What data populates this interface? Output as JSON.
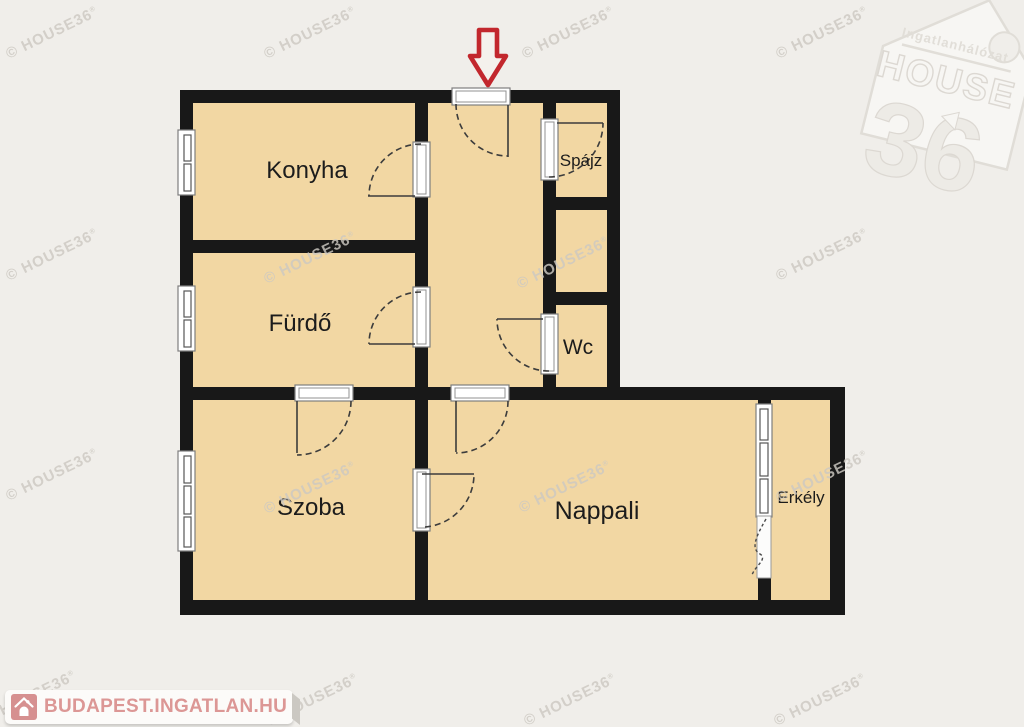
{
  "branding": {
    "watermark_text": "© HOUSE36",
    "watermark_mark": "®",
    "logo": {
      "tagline": "Ingatlanhálózat",
      "name": "HOUSE",
      "number": "36"
    },
    "footer_site": "BUDAPEST.INGATLAN.HU"
  },
  "floorplan": {
    "rooms": [
      {
        "id": "konyha",
        "label": "Konyha"
      },
      {
        "id": "furdo",
        "label": "Fürdő"
      },
      {
        "id": "spajz",
        "label": "Spájz"
      },
      {
        "id": "wc",
        "label": "Wc"
      },
      {
        "id": "szoba",
        "label": "Szoba"
      },
      {
        "id": "nappali",
        "label": "Nappali"
      },
      {
        "id": "erkely",
        "label": "Erkély"
      }
    ],
    "entrance_marker": "entrance-arrow"
  },
  "colors": {
    "background": "#f0eeea",
    "room_fill": "#f2d7a3",
    "wall": "#181818",
    "arrow_red": "#c2272d",
    "footer_text": "#dc9795",
    "footer_icon": "#d69090",
    "watermark": "#cdc9c2"
  }
}
